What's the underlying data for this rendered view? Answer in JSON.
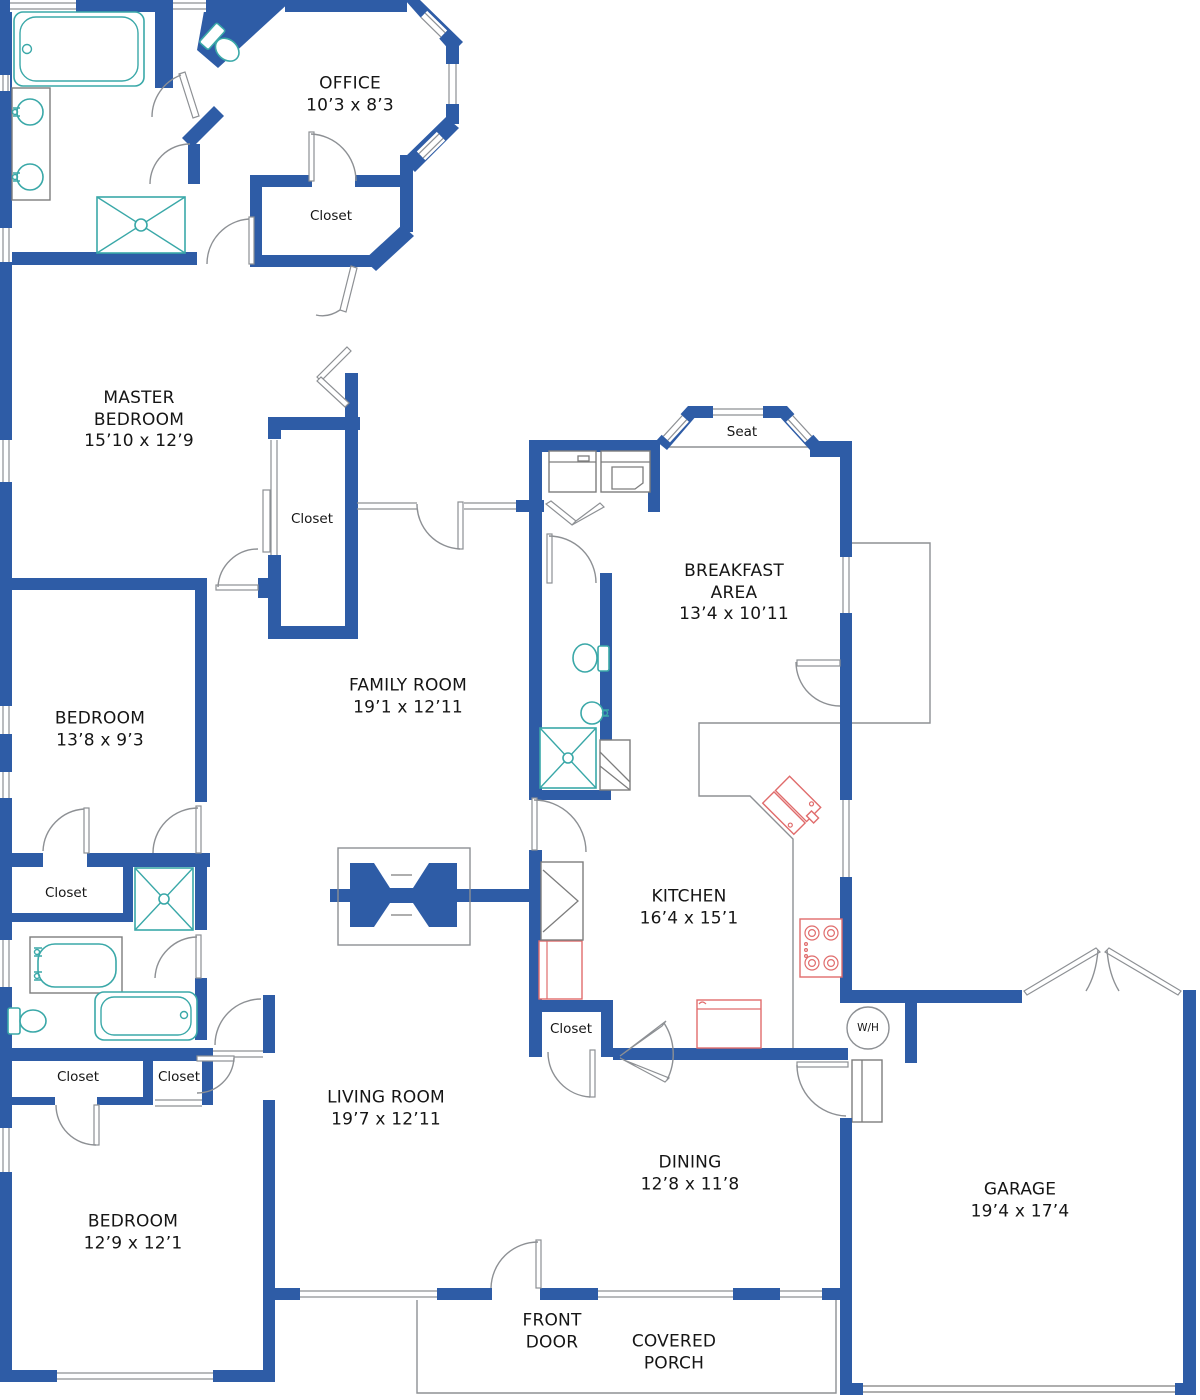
{
  "colors": {
    "wall": "#2e5ca6",
    "fixture": "#3aa8a8",
    "appliance": "#e06c6c",
    "line": "#8d9094",
    "text": "#151515"
  },
  "rooms": {
    "office": {
      "name": "OFFICE",
      "dims": "10’3 x 8’3"
    },
    "master_bedroom": {
      "line1": "MASTER",
      "line2": "BEDROOM",
      "dims": "15’10 x 12’9"
    },
    "breakfast_area": {
      "line1": "BREAKFAST",
      "line2": "AREA",
      "dims": "13’4 x 10’11"
    },
    "family_room": {
      "name": "FAMILY ROOM",
      "dims": "19’1 x 12’11"
    },
    "bedroom_middle": {
      "name": "BEDROOM",
      "dims": "13’8 x 9’3"
    },
    "kitchen": {
      "name": "KITCHEN",
      "dims": "16’4 x 15’1"
    },
    "living_room": {
      "name": "LIVING ROOM",
      "dims": "19’7 x 12’11"
    },
    "dining": {
      "name": "DINING",
      "dims": "12’8 x 11’8"
    },
    "garage": {
      "name": "GARAGE",
      "dims": "19’4 x 17’4"
    },
    "bedroom_bottom": {
      "name": "BEDROOM",
      "dims": "12’9 x 12’1"
    }
  },
  "closets": {
    "office": "Closet",
    "master": "Closet",
    "hall": "Closet",
    "kitchen": "Closet",
    "bedroom_left": "Closet",
    "bedroom_right": "Closet"
  },
  "labels": {
    "seat": "Seat",
    "water_heater": "W/H",
    "front_door_line1": "FRONT",
    "front_door_line2": "DOOR",
    "porch_line1": "COVERED",
    "porch_line2": "PORCH"
  }
}
